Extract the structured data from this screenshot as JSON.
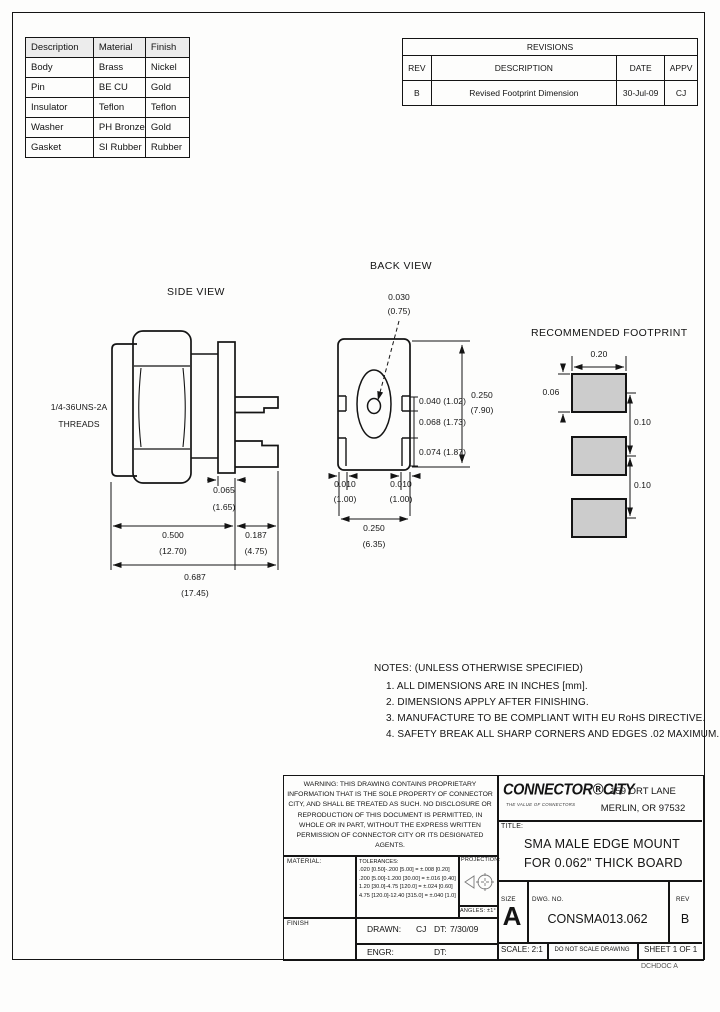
{
  "page": {
    "corner_text": "DCHDOC A"
  },
  "materials_table": {
    "headers": [
      "Description",
      "Material",
      "Finish"
    ],
    "rows": [
      [
        "Body",
        "Brass",
        "Nickel"
      ],
      [
        "Pin",
        "BE CU",
        "Gold"
      ],
      [
        "Insulator",
        "Teflon",
        "Teflon"
      ],
      [
        "Washer",
        "PH Bronze",
        "Gold"
      ],
      [
        "Gasket",
        "SI Rubber",
        "Rubber"
      ]
    ]
  },
  "revisions_table": {
    "title": "REVISIONS",
    "headers": [
      "REV",
      "DESCRIPTION",
      "DATE",
      "APPV"
    ],
    "rows": [
      [
        "B",
        "Revised Footprint Dimension",
        "30-Jul-09",
        "CJ"
      ]
    ]
  },
  "views": {
    "side_view_label": "SIDE VIEW",
    "back_view_label": "BACK VIEW",
    "footprint_label": "RECOMMENDED FOOTPRINT"
  },
  "dimensions": {
    "side": {
      "threads_line1": "1/4-36UNS-2A",
      "threads_line2": "THREADS",
      "flange_thickness_in": "0.065",
      "flange_thickness_mm": "(1.65)",
      "body_length_in": "0.500",
      "body_length_mm": "(12.70)",
      "leg_length_in": "0.187",
      "leg_length_mm": "(4.75)",
      "overall_length_in": "0.687",
      "overall_length_mm": "(17.45)"
    },
    "back": {
      "pin_dia_in": "0.030",
      "pin_dia_mm": "(0.75)",
      "dim_top": "0.040 (1.02)",
      "dim_mid": "0.068 (1.73)",
      "dim_bottom": "0.074 (1.87)",
      "height_in": "0.250",
      "height_mm": "(7.90)",
      "tab_left_in": "0.010",
      "tab_left_mm": "(1.00)",
      "tab_right_in": "0.010",
      "tab_right_mm": "(1.00)",
      "width_in": "0.250",
      "width_mm": "(6.35)"
    },
    "footprint": {
      "pad_width": "0.20",
      "pad_height": "0.06",
      "pitch_top": "0.10",
      "pitch_bottom": "0.10"
    }
  },
  "notes": {
    "heading": "NOTES: (UNLESS OTHERWISE SPECIFIED)",
    "items": [
      "1.  ALL DIMENSIONS ARE IN INCHES [mm].",
      "2.  DIMENSIONS APPLY AFTER FINISHING.",
      "3.  MANUFACTURE TO BE COMPLIANT WITH EU RoHS DIRECTIVE.",
      "4.  SAFETY BREAK ALL SHARP CORNERS AND EDGES .02 MAXIMUM."
    ]
  },
  "title_block": {
    "warning": "WARNING:  THIS DRAWING CONTAINS PROPRIETARY  INFORMATION THAT IS THE SOLE  PROPERTY OF CONNECTOR CITY, AND SHALL BE TREATED AS SUCH.  NO DISCLOSURE OR REPRODUCTION OF THIS DOCUMENT IS PERMITTED, IN WHOLE OR  IN  PART, WITHOUT THE EXPRESS WRITTEN  PERMISSION  OF CONNECTOR CITY OR ITS DESIGNATED AGENTS.",
    "company": {
      "name": "CONNECTOR®CITY",
      "tagline": "THE VALUE OF CONNECTORS",
      "address_line1": "159 ORT LANE",
      "address_line2": "MERLIN, OR  97532"
    },
    "title_label": "TITLE:",
    "title_line1": "SMA MALE EDGE MOUNT",
    "title_line2": "FOR 0.062\" THICK BOARD",
    "material_label": "MATERIAL:",
    "finish_label": "FINISH",
    "tolerances_label": "TOLERANCES:",
    "tolerance_lines": [
      ".020 [0.50]-.200 [5.00] = ±.008 [0.20]",
      ".200 [5.00]-1.200 [30.00] = ±.016 [0.40]",
      "1.20 [30.0]-4.75 [120.0] = ±.024 [0.60]",
      "4.75 [120.0]-12.40 [315.0] = ±.040 [1.0]"
    ],
    "projection_label": "PROJECTION:",
    "angles_text": "ANGLES: ±1°",
    "drawn_label": "DRAWN:",
    "drawn_by": "CJ",
    "drawn_date_label": "DT:",
    "drawn_date": "7/30/09",
    "engr_label": "ENGR:",
    "engr_date_label": "DT:",
    "size_label": "SIZE",
    "size_value": "A",
    "dwg_no_label": "DWG. NO.",
    "dwg_no": "CONSMA013.062",
    "rev_label": "REV",
    "rev_value": "B",
    "scale_text": "SCALE: 2:1",
    "do_not_scale_text": "DO NOT SCALE DRAWING",
    "sheet_text": "SHEET 1 OF 1"
  },
  "colors": {
    "line": "#141414",
    "pad_fill": "#cccccc",
    "table_header_bg": "#ececec",
    "paper": "#fdfdfc"
  }
}
